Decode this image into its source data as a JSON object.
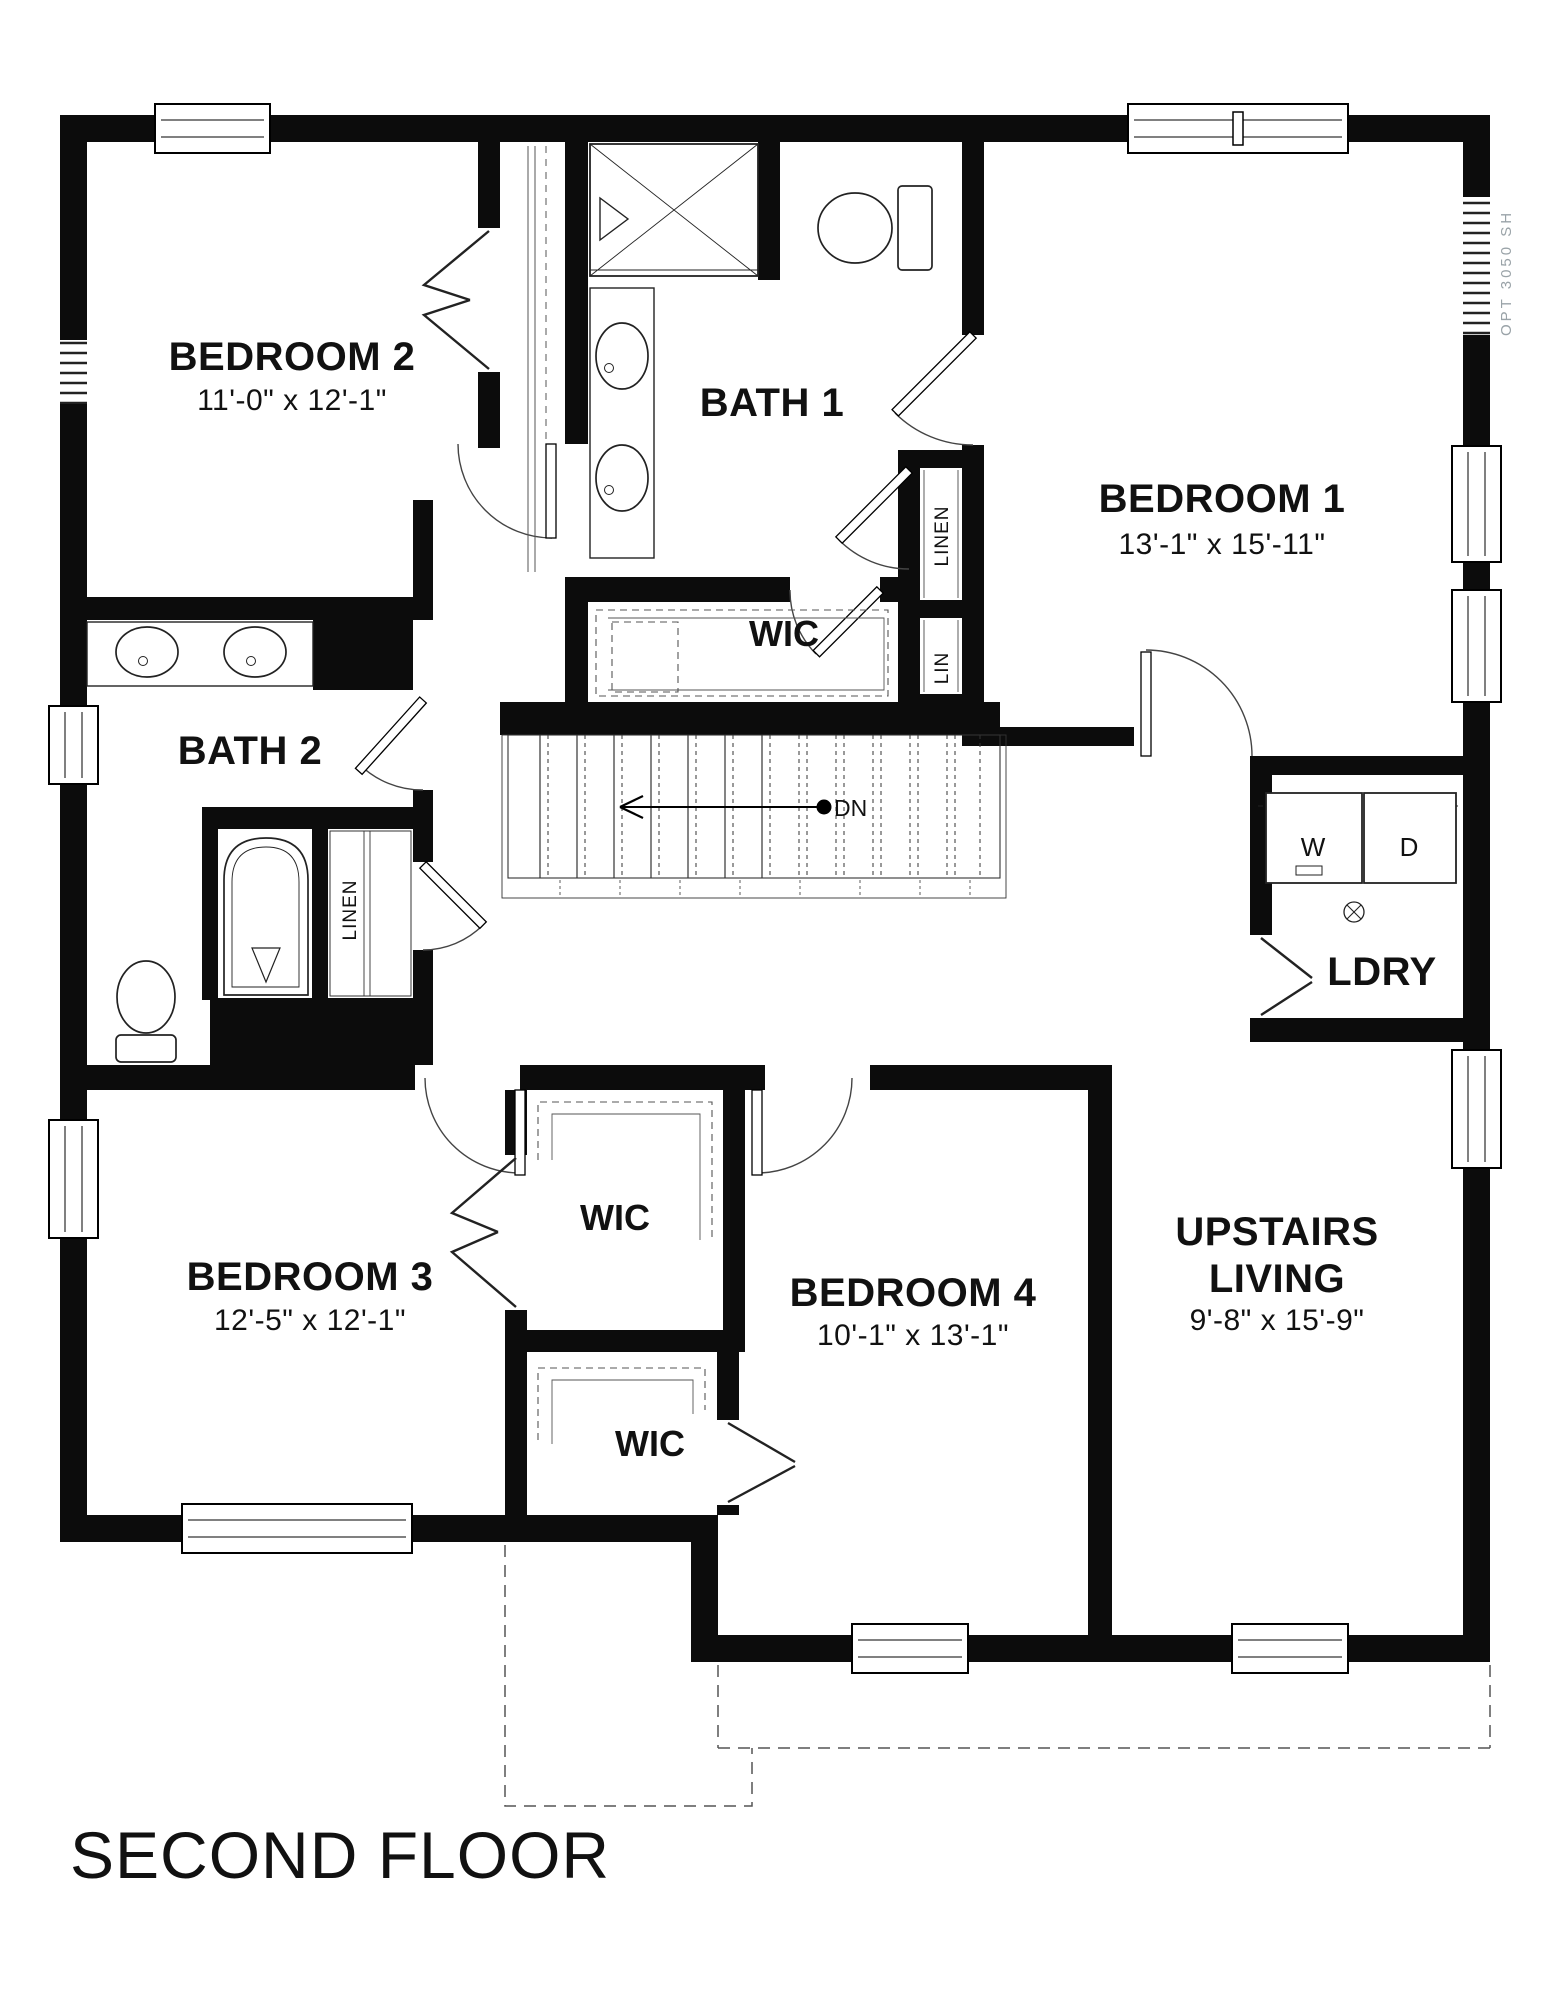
{
  "title": "SECOND FLOOR",
  "annotations": {
    "down": "DN",
    "opt_window": "OPT 3050 SH"
  },
  "rooms": {
    "bedroom2": {
      "name": "BEDROOM 2",
      "dims": "11'-0\" x 12'-1\""
    },
    "bath1": {
      "name": "BATH 1"
    },
    "bedroom1": {
      "name": "BEDROOM 1",
      "dims": "13'-1\" x 15'-11\""
    },
    "bath2": {
      "name": "BATH 2"
    },
    "wic_upper": {
      "name": "WIC"
    },
    "laundry": {
      "name": "LDRY"
    },
    "bedroom3": {
      "name": "BEDROOM 3",
      "dims": "12'-5\" x 12'-1\""
    },
    "wic_bedroom3": {
      "name": "WIC"
    },
    "wic_bedroom4": {
      "name": "WIC"
    },
    "bedroom4": {
      "name": "BEDROOM 4",
      "dims": "10'-1\" x 13'-1\""
    },
    "upstairs_living": {
      "name_line1": "UPSTAIRS",
      "name_line2": "LIVING",
      "dims": "9'-8\" x 15'-9\""
    }
  },
  "closets": {
    "linen_bath1": "LINEN",
    "lin_bath1": "LIN",
    "linen_bath2": "LINEN"
  },
  "appliances": {
    "washer": "W",
    "dryer": "D"
  }
}
